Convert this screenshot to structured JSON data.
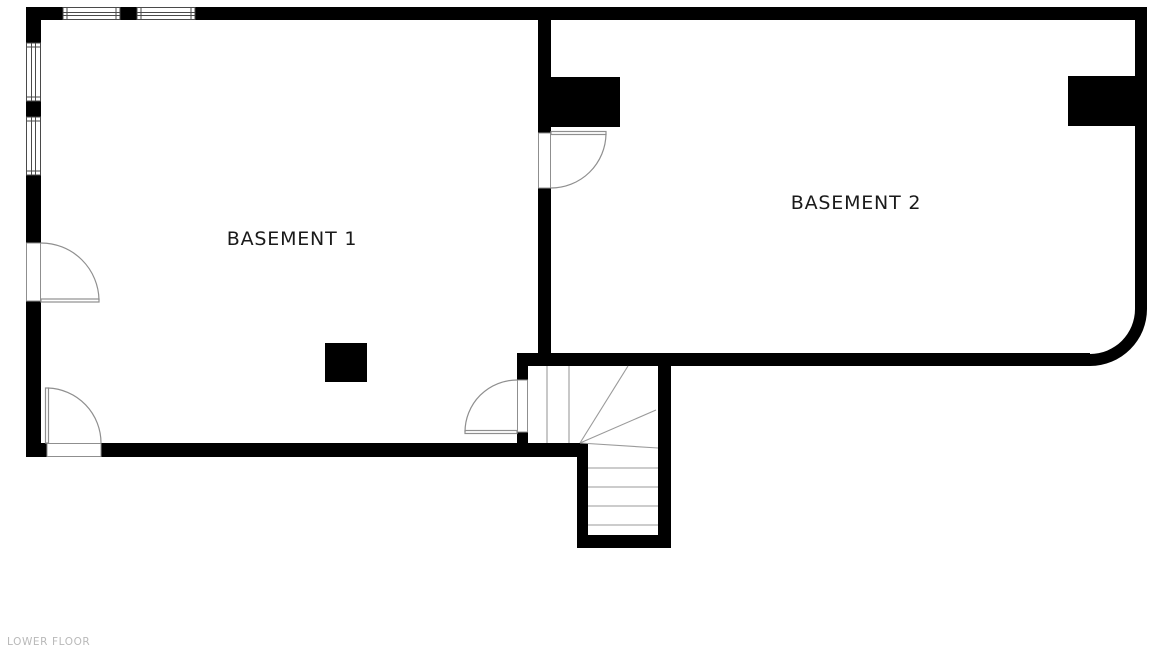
{
  "plan": {
    "floor_label": "LOWER FLOOR",
    "rooms": [
      {
        "label": "BASEMENT 1"
      },
      {
        "label": "BASEMENT 2"
      }
    ],
    "features": {
      "doors": 4,
      "windows": 4,
      "pillars": 3,
      "staircase": "L-shaped winder staircase"
    },
    "colors": {
      "wall": "#000000",
      "thin_line": "#8f8f8f",
      "room_label": "#1a1a1a",
      "floor_label": "#b9b9b9",
      "background": "#ffffff"
    }
  }
}
